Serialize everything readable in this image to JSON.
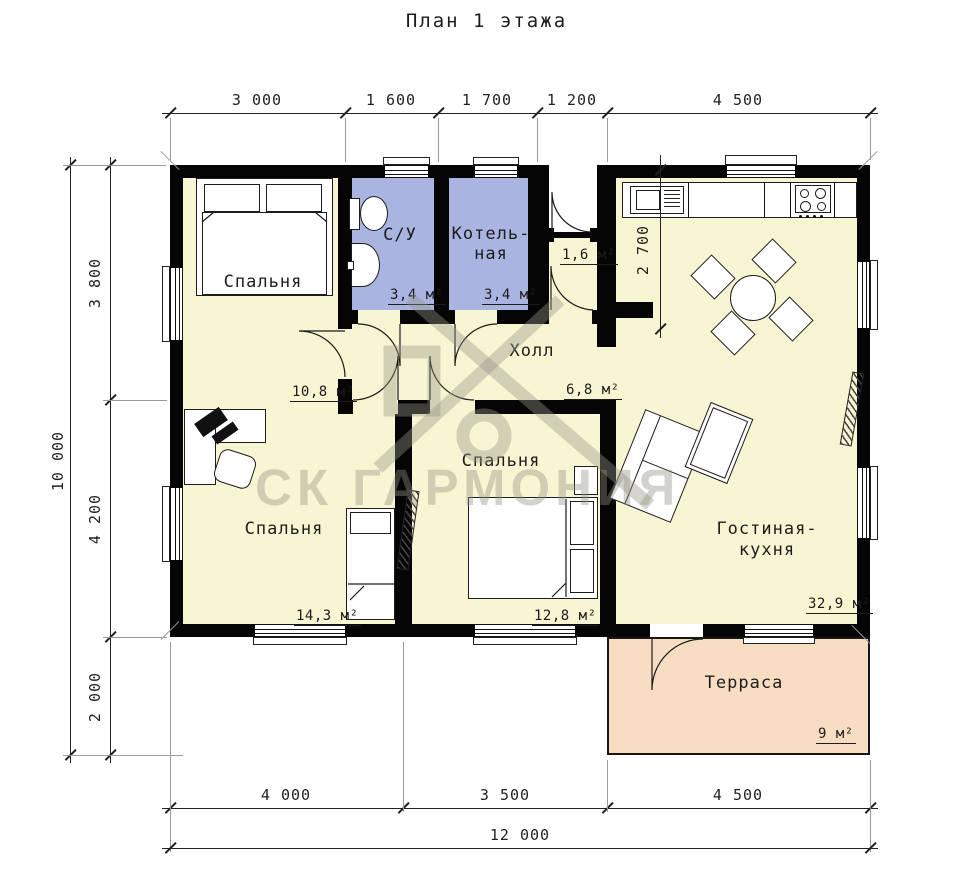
{
  "title": "План 1 этажа",
  "watermark": "СК ГАРМОНИЯ",
  "colors": {
    "wall": "#050505",
    "room_fill": "#f8f5d2",
    "wet_room_fill": "#a9b4e0",
    "terrace_fill": "#f8ddc2"
  },
  "dimensions": {
    "top": [
      "3 000",
      "1 600",
      "1 700",
      "1 200",
      "4 500"
    ],
    "left_total": "10 000",
    "left": [
      "3 800",
      "4 200",
      "2 000"
    ],
    "bottom": [
      "4 000",
      "3 500",
      "4 500"
    ],
    "bottom_total": "12 000",
    "kitchen_depth": "2 700"
  },
  "rooms": {
    "bedroom1": {
      "name": "Спальня",
      "area": "10,8 м²"
    },
    "bathroom": {
      "name": "С/У",
      "area": "3,4 м²"
    },
    "boiler": {
      "name_line1": "Котель-",
      "name_line2": "ная",
      "area": "3,4 м²"
    },
    "vestibule": {
      "area": "1,6 м²"
    },
    "hall": {
      "name": "Холл",
      "area": "6,8 м²"
    },
    "bedroom2": {
      "name": "Спальня",
      "area": "14,3 м²"
    },
    "bedroom3": {
      "name": "Спальня",
      "area": "12,8 м²"
    },
    "living": {
      "name_line1": "Гостиная-",
      "name_line2": "кухня",
      "area": "32,9 м²"
    },
    "terrace": {
      "name": "Терраса",
      "area": "9 м²"
    }
  }
}
